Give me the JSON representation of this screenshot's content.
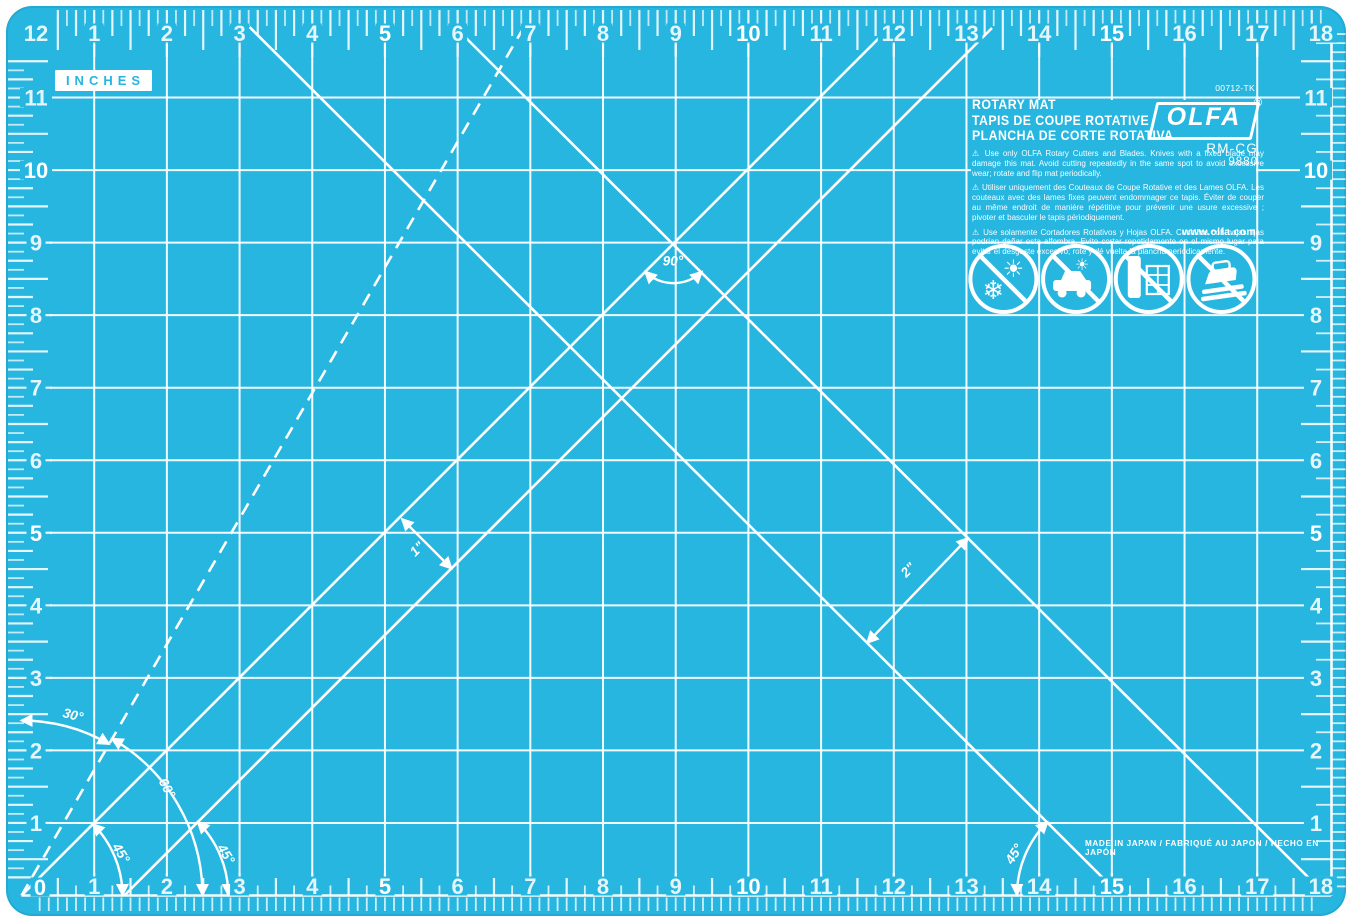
{
  "page": {
    "background": "#ffffff"
  },
  "mat": {
    "colors": {
      "base": "#26b6e0",
      "grid": "rgba(255,255,255,0.95)",
      "tick": "rgba(255,255,255,0.80)",
      "marking": "#ffffff",
      "number": "rgba(255,255,255,0.88)",
      "number_bold": "#ffffff",
      "inches_text": "#26b6e0",
      "inches_bg": "#ffffff"
    },
    "unit_label": "INCHES",
    "rulers": {
      "top_numbers": [
        "1",
        "2",
        "3",
        "4",
        "5",
        "6",
        "7",
        "8",
        "9",
        "10",
        "11",
        "12",
        "13",
        "14",
        "15",
        "16",
        "17",
        "18"
      ],
      "left_numbers": [
        "12",
        "11",
        "10",
        "9",
        "8",
        "7",
        "6",
        "5",
        "4",
        "3",
        "2",
        "1"
      ],
      "right_numbers": [
        "11",
        "10",
        "9",
        "8",
        "7",
        "6",
        "5",
        "4",
        "3",
        "2",
        "1"
      ],
      "bottom_numbers": [
        "1",
        "2",
        "3",
        "4",
        "5",
        "6",
        "7",
        "8",
        "9",
        "10",
        "11",
        "12",
        "13",
        "14",
        "15",
        "16",
        "17",
        "18"
      ],
      "corner_zero": "0",
      "bold_values": [
        0,
        5,
        10,
        15
      ]
    },
    "angle_labels": {
      "a30": "30°",
      "a45": "45°",
      "a60": "60°",
      "a90": "90°",
      "m1": "1\"",
      "m2": "2\""
    },
    "info": {
      "part_no": "00712-TK",
      "title1": "ROTARY MAT",
      "title2": "TAPIS DE COUPE ROTATIVE",
      "title3": "PLANCHA DE CORTE ROTATIVA",
      "warning_en": "⚠ Use only OLFA Rotary Cutters and Blades. Knives with a fixed blade may damage this mat. Avoid cutting repeatedly in the same spot to avoid excessive wear; rotate and flip mat periodically.",
      "warning_fr": "⚠ Utiliser uniquement des Couteaux de Coupe Rotative et des Lames OLFA. Les couteaux avec des lames fixes peuvent endommager ce tapis. Éviter de couper au même endroit de manière répétitive pour prévenir une usure excessive ; pivoter et basculer le tapis périodiquement.",
      "warning_es": "⚠ Use solamente Cortadores Rotativos y Hojas OLFA. Cuchillos con hojas fijas podrían dañar esta alfombra. Evite cortar repetidamente en el mismo lugar para evitar el desgaste excesivo; rote y dé vuelta la plancha periódicamente.",
      "website": "www.olfa.com",
      "brand": "OLFA",
      "brand_reg": "®",
      "model": "RM-CG",
      "model_num": "9880",
      "made_in": "MADE IN  JAPAN / FABRIQUÉ AU JAPON / HECHO EN JAPÓN"
    },
    "icons": [
      {
        "name": "no-sun-frost-icon"
      },
      {
        "name": "no-hot-car-icon"
      },
      {
        "name": "no-window-lean-icon"
      },
      {
        "name": "no-iron-icon"
      }
    ]
  }
}
